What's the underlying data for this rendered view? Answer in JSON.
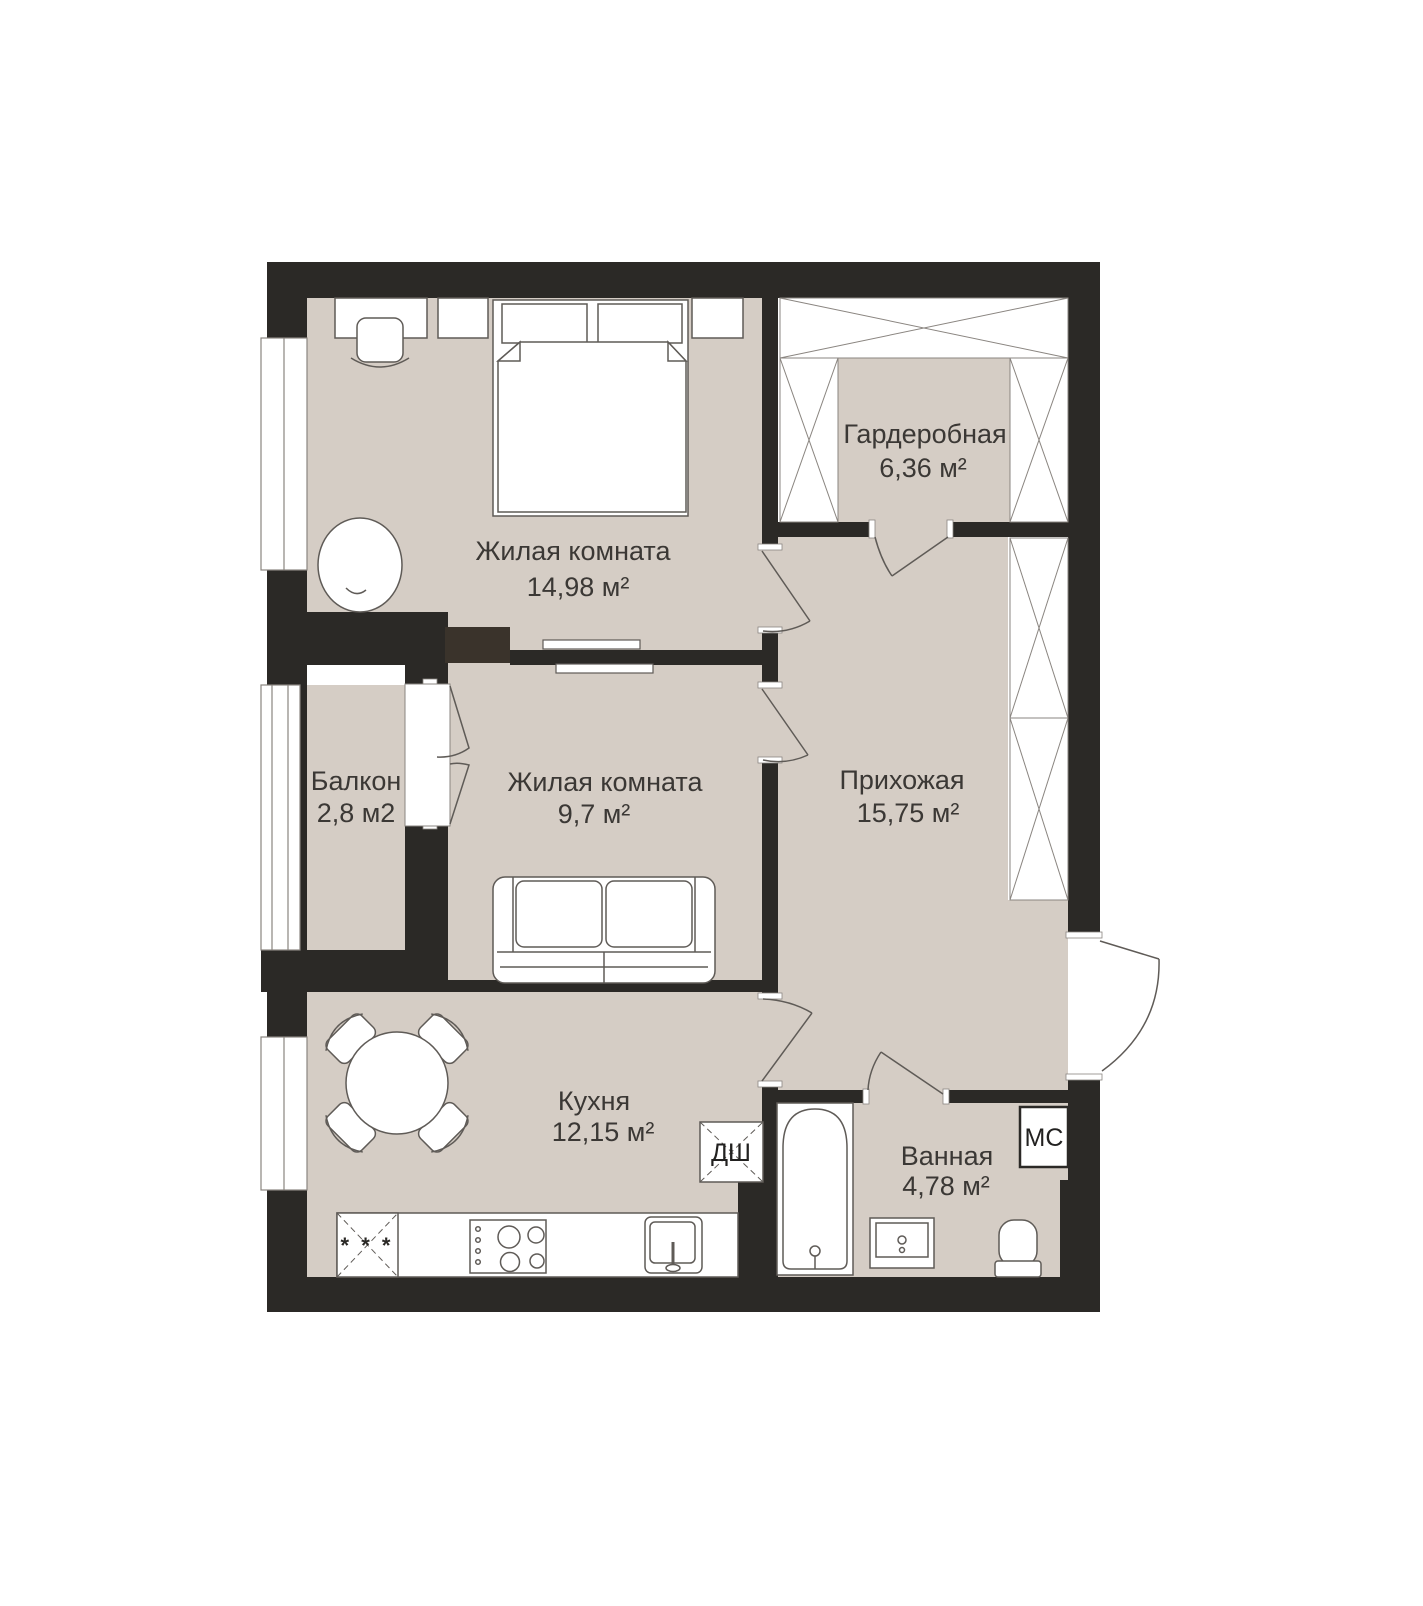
{
  "plan": {
    "type": "apartment-floor-plan",
    "rooms": [
      {
        "id": "bedroom1",
        "name": "Жилая комната",
        "area": "14,98 м²"
      },
      {
        "id": "wardrobe",
        "name": "Гардеробная",
        "area": "6,36 м²"
      },
      {
        "id": "balcony",
        "name": "Балкон",
        "area": "2,8 м2"
      },
      {
        "id": "bedroom2",
        "name": "Жилая комната",
        "area": "9,7 м²"
      },
      {
        "id": "hallway",
        "name": "Прихожая",
        "area": "15,75 м²"
      },
      {
        "id": "kitchen",
        "name": "Кухня",
        "area": "12,15 м²"
      },
      {
        "id": "bathroom",
        "name": "Ванная",
        "area": "4,78 м²"
      }
    ],
    "markers": {
      "duct_shaft": "ДШ",
      "utility_cabinet": "МС",
      "fridge_marks": "* * *"
    },
    "colors": {
      "wall": "#2b2926",
      "floor": "#d5cdc5",
      "outline": "#5f5b57",
      "text": "#3b3835"
    }
  }
}
